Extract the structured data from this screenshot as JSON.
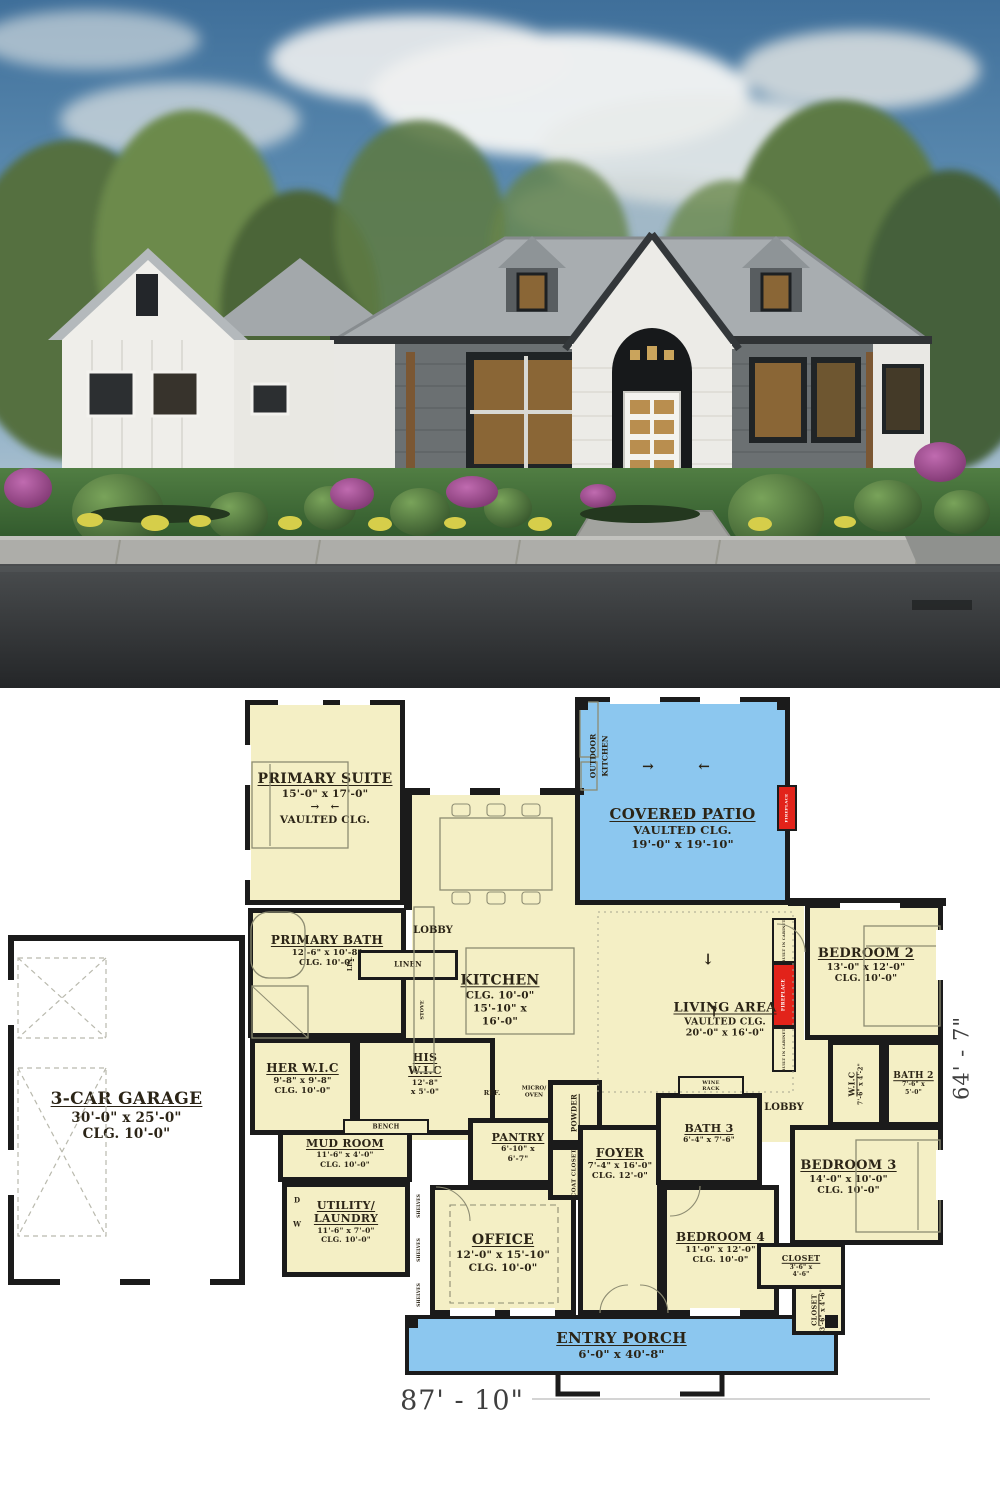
{
  "colors": {
    "room_fill": "#f4efc5",
    "patio_fill": "#8cc7ef",
    "wall": "#1b1b1b",
    "fireplace_red": "#e2231a",
    "label_ink": "#2b2416",
    "furniture_line": "#8d8c72"
  },
  "photo": {
    "description_colors": {
      "sky": "#4f7ea3",
      "roof": "#a8adb0",
      "siding_dark": "#6b7072",
      "siding_white": "#eceae5",
      "grass": "#3f6d38",
      "road": "#3a3d3f",
      "shrub_purple": "#a2408f"
    }
  },
  "dimensions": {
    "overall_width": "87' - 10\"",
    "overall_height": "64' - 7\""
  },
  "plan": {
    "fills": {
      "cream": "#f4efc5",
      "blue": "#8cc7ef",
      "white": "#ffffff",
      "red": "#e2231a"
    },
    "rooms": [
      {
        "id": "great-room-floor",
        "x": 412,
        "y": 900,
        "w": 392,
        "h": 240,
        "fill": "cream",
        "bw": 0
      },
      {
        "id": "dining-floor",
        "x": 408,
        "y": 790,
        "w": 172,
        "h": 115,
        "fill": "cream",
        "bw": 0
      },
      {
        "id": "linen-hall-floor",
        "x": 350,
        "y": 976,
        "w": 64,
        "h": 64,
        "fill": "cream",
        "bw": 0
      },
      {
        "id": "bedroom-hall-floor",
        "x": 756,
        "y": 1040,
        "w": 104,
        "h": 102,
        "fill": "cream",
        "bw": 0
      },
      {
        "id": "covered-patio",
        "title": "COVERED PATIO",
        "lines": [
          "VAULTED CLG.",
          "19'-0\" x 19'-10\""
        ],
        "x": 575,
        "y": 697,
        "w": 215,
        "h": 208,
        "fill": "blue",
        "ts": 15,
        "ly": 103
      },
      {
        "id": "entry-porch",
        "title": "ENTRY PORCH",
        "lines": [
          "6'-0\" x 40'-8\""
        ],
        "x": 405,
        "y": 1315,
        "w": 433,
        "h": 60,
        "fill": "blue",
        "ts": 15,
        "ly": 10,
        "bw": 4
      },
      {
        "id": "garage",
        "title": "3-CAR GARAGE",
        "lines": [
          "30'-0\" x 25'-0\"",
          "CLG. 10'-0\""
        ],
        "x": 8,
        "y": 935,
        "w": 237,
        "h": 350,
        "fill": "white",
        "ts": 17,
        "ly": 148,
        "bw": 6
      },
      {
        "id": "primary-suite",
        "title": "PRIMARY SUITE",
        "lines": [
          "15'-0\" x 17'-0\"",
          "→  ←",
          "VAULTED CLG."
        ],
        "x": 245,
        "y": 700,
        "w": 160,
        "h": 205,
        "ts": 14,
        "ly": 66
      },
      {
        "id": "primary-bath",
        "title": "PRIMARY BATH",
        "lines": [
          "12'-6\" x 10'-8\"",
          "CLG. 10'-0\""
        ],
        "x": 248,
        "y": 908,
        "w": 158,
        "h": 130,
        "ts": 12,
        "ly": 20
      },
      {
        "id": "linen",
        "title": "LINEN",
        "x": 358,
        "y": 950,
        "w": 100,
        "h": 30,
        "ts": 7,
        "u": false,
        "bw": 3
      },
      {
        "id": "her-wic",
        "title": "HER W.I.C",
        "lines": [
          "9'-8\" x 9'-8\"",
          "CLG. 10'-0\""
        ],
        "x": 250,
        "y": 1038,
        "w": 105,
        "h": 97,
        "ts": 12,
        "ly": 18
      },
      {
        "id": "his-wic",
        "title_lines": [
          "HIS",
          "W.I.C"
        ],
        "lines": [
          "12'-8\"",
          "x 5'-0\""
        ],
        "x": 355,
        "y": 1038,
        "w": 140,
        "h": 97,
        "ts": 11,
        "ly": 8
      },
      {
        "id": "mud-room",
        "title": "MUD ROOM",
        "lines": [
          "11'-6\" x 4'-0\"",
          "CLG. 10'-0\""
        ],
        "x": 278,
        "y": 1130,
        "w": 134,
        "h": 52,
        "ts": 11,
        "ly": 2
      },
      {
        "id": "bench",
        "title": "BENCH",
        "x": 343,
        "y": 1119,
        "w": 86,
        "h": 16,
        "ts": 6,
        "u": false,
        "bw": 2
      },
      {
        "id": "utility-laundry",
        "title_lines": [
          "UTILITY/",
          "LAUNDRY"
        ],
        "lines": [
          "11'-6\" x 7'-0\"",
          "CLG. 10'-0\""
        ],
        "x": 282,
        "y": 1182,
        "w": 128,
        "h": 95,
        "ts": 11,
        "ly": 12
      },
      {
        "id": "office",
        "title": "OFFICE",
        "lines": [
          "12'-0\" x 15'-10\"",
          "CLG. 10'-0\""
        ],
        "x": 430,
        "y": 1185,
        "w": 146,
        "h": 130,
        "ts": 14,
        "ly": 42
      },
      {
        "id": "pantry",
        "title": "PANTRY",
        "lines": [
          "6'-10\" x",
          "6'-7\""
        ],
        "x": 468,
        "y": 1118,
        "w": 100,
        "h": 67,
        "ts": 11,
        "ly": 8
      },
      {
        "id": "powder",
        "title": "POWDER",
        "x": 548,
        "y": 1080,
        "w": 54,
        "h": 65,
        "ts": 7,
        "rot": -90
      },
      {
        "id": "coat-closet",
        "title": "COAT CLOSET",
        "x": 548,
        "y": 1145,
        "w": 54,
        "h": 55,
        "ts": 5.5,
        "rot": -90
      },
      {
        "id": "foyer",
        "title": "FOYER",
        "lines": [
          "7'-4\" x 16'-0\"",
          "CLG. 12'-0\""
        ],
        "x": 578,
        "y": 1125,
        "w": 84,
        "h": 190,
        "ts": 12,
        "ly": 16
      },
      {
        "id": "bath-3",
        "title": "BATH 3",
        "lines": [
          "6'-4\" x 7'-6\""
        ],
        "x": 656,
        "y": 1093,
        "w": 106,
        "h": 92,
        "ts": 11,
        "ly": 24
      },
      {
        "id": "wine-rack",
        "title_lines": [
          "WINE",
          "RACK"
        ],
        "x": 678,
        "y": 1076,
        "w": 66,
        "h": 20,
        "ts": 5,
        "u": false,
        "bw": 2
      },
      {
        "id": "bedroom-2",
        "title": "BEDROOM 2",
        "lines": [
          "13'-0\" x 12'-0\"",
          "CLG. 10'-0\""
        ],
        "x": 805,
        "y": 903,
        "w": 138,
        "h": 137,
        "ts": 13,
        "ly": 38,
        "lx": -8
      },
      {
        "id": "wic-2",
        "title": "W.I.C",
        "lines": [
          "7'-6\" x 4'-2\""
        ],
        "x": 828,
        "y": 1040,
        "w": 56,
        "h": 87,
        "ts": 8,
        "rot": -90
      },
      {
        "id": "bath-2",
        "title": "BATH 2",
        "lines": [
          "7'-6\" x",
          "5'-0\""
        ],
        "x": 884,
        "y": 1040,
        "w": 59,
        "h": 87,
        "ts": 9
      },
      {
        "id": "bedroom-3",
        "title": "BEDROOM 3",
        "lines": [
          "14'-0\" x 10'-0\"",
          "CLG. 10'-0\""
        ],
        "x": 790,
        "y": 1125,
        "w": 153,
        "h": 120,
        "ts": 13,
        "ly": 28,
        "lx": -18
      },
      {
        "id": "bedroom-4",
        "title": "BEDROOM 4",
        "lines": [
          "11'-0\" x 12'-0\"",
          "CLG. 10'-0\""
        ],
        "x": 662,
        "y": 1185,
        "w": 117,
        "h": 130,
        "ts": 12,
        "ly": 40
      },
      {
        "id": "closet-bedroom4",
        "title": "CLOSET",
        "lines": [
          "3'-6\" x",
          "4'-6\""
        ],
        "x": 757,
        "y": 1243,
        "w": 88,
        "h": 46,
        "ts": 8,
        "bw": 4
      },
      {
        "id": "closet-bedroom3",
        "title": "CLOSET",
        "lines": [
          "3'-6\" x 4'-6\""
        ],
        "x": 792,
        "y": 1285,
        "w": 53,
        "h": 50,
        "ts": 6.5,
        "rot": -90,
        "bw": 4
      },
      {
        "id": "built-in-cabinet-top",
        "title": "BUILT IN CABINET",
        "x": 772,
        "y": 918,
        "w": 24,
        "h": 45,
        "ts": 3.5,
        "rot": -90,
        "u": false,
        "bw": 2
      },
      {
        "id": "fireplace-living",
        "title": "FIREPLACE",
        "x": 772,
        "y": 963,
        "w": 24,
        "h": 64,
        "ts": 4.5,
        "rot": -90,
        "fill": "red",
        "color": "#ffffff",
        "u": false,
        "bw": 2
      },
      {
        "id": "built-in-cabinet-bottom",
        "title": "BUILT IN CABINET",
        "x": 772,
        "y": 1027,
        "w": 24,
        "h": 45,
        "ts": 3.5,
        "rot": -90,
        "u": false,
        "bw": 2
      },
      {
        "id": "fireplace-patio",
        "title": "FIREPLACE",
        "x": 777,
        "y": 785,
        "w": 20,
        "h": 46,
        "ts": 4,
        "rot": -90,
        "fill": "red",
        "color": "#ffffff",
        "u": false,
        "bw": 2
      },
      {
        "id": "kitchen",
        "title": "KITCHEN",
        "lines": [
          "CLG. 10'-0\"",
          "15'-10\" x",
          "16'-0\""
        ],
        "x": 430,
        "y": 955,
        "w": 140,
        "h": 90,
        "nobox": true,
        "ts": 14
      },
      {
        "id": "living-area",
        "title": "LIVING AREA",
        "lines": [
          "VAULTED CLG.",
          "20'-0\" x 16'-0\""
        ],
        "x": 610,
        "y": 985,
        "w": 230,
        "h": 70,
        "nobox": true,
        "ts": 13
      }
    ],
    "walls": [
      [
        404,
        788,
        180,
        7
      ],
      [
        404,
        788,
        8,
        122
      ],
      [
        788,
        898,
        158,
        8
      ]
    ],
    "annotations": [
      {
        "t": "LOBBY",
        "x": 433,
        "y": 931,
        "s": 10
      },
      {
        "t": "LOBBY",
        "x": 784,
        "y": 1108,
        "s": 10
      },
      {
        "t": "LIN.",
        "x": 351,
        "y": 964,
        "s": 6,
        "r": -90
      },
      {
        "t": "REF.",
        "x": 492,
        "y": 1093,
        "s": 6.5
      },
      {
        "t": "MICRO/",
        "x": 534,
        "y": 1089,
        "s": 5.5
      },
      {
        "t": "OVEN",
        "x": 534,
        "y": 1096,
        "s": 5.5
      },
      {
        "t": "STOVE",
        "x": 423,
        "y": 1010,
        "s": 5,
        "r": -90
      },
      {
        "t": "W",
        "x": 297,
        "y": 1224,
        "s": 7
      },
      {
        "t": "D",
        "x": 297,
        "y": 1200,
        "s": 7
      },
      {
        "t": "SHELVES",
        "x": 420,
        "y": 1206,
        "s": 4.5,
        "r": -90
      },
      {
        "t": "SHELVES",
        "x": 420,
        "y": 1250,
        "s": 4.5,
        "r": -90
      },
      {
        "t": "SHELVES",
        "x": 420,
        "y": 1295,
        "s": 4.5,
        "r": -90
      },
      {
        "t": "OUTDOOR",
        "x": 593,
        "y": 756,
        "s": 7.5,
        "r": -90
      },
      {
        "t": "KITCHEN",
        "x": 605,
        "y": 756,
        "s": 7.5,
        "r": -90
      },
      {
        "t": "→",
        "x": 648,
        "y": 767,
        "s": 14
      },
      {
        "t": "←",
        "x": 704,
        "y": 767,
        "s": 14
      },
      {
        "t": "↓",
        "x": 708,
        "y": 960,
        "s": 15
      },
      {
        "t": "↑",
        "x": 714,
        "y": 1012,
        "s": 15
      },
      {
        "t": "87' - 10\"",
        "x": 462,
        "y": 1401,
        "s": 27,
        "f": "dim"
      },
      {
        "t": "64' - 7\"",
        "x": 962,
        "y": 1058,
        "s": 21,
        "r": -90,
        "f": "dim"
      }
    ],
    "furniture": {
      "dashed_x_boxes": [
        [
          18,
          958,
          88,
          80
        ],
        [
          18,
          1068,
          88,
          168
        ]
      ],
      "outline_rects": [
        [
          252,
          762,
          96,
          86
        ],
        [
          440,
          818,
          112,
          72
        ],
        [
          466,
          948,
          108,
          86
        ],
        [
          414,
          907,
          20,
          165
        ],
        [
          864,
          926,
          76,
          100
        ],
        [
          856,
          1140,
          84,
          92
        ],
        [
          580,
          702,
          18,
          55
        ],
        [
          581,
          762,
          16,
          28
        ]
      ],
      "round_rects": [
        [
          251,
          912,
          54,
          66
        ]
      ],
      "shower": [
        252,
        986,
        56,
        52
      ],
      "chair_stubs": [
        [
          452,
          804,
          18,
          12
        ],
        [
          487,
          804,
          18,
          12
        ],
        [
          522,
          804,
          18,
          12
        ],
        [
          452,
          892,
          18,
          12
        ],
        [
          487,
          892,
          18,
          12
        ],
        [
          522,
          892,
          18,
          12
        ]
      ],
      "dashed_rects": [
        [
          450,
          1205,
          108,
          98
        ]
      ],
      "dotted_rects": [
        [
          598,
          912,
          195,
          180
        ]
      ],
      "lines": [
        [
          270,
          764,
          270,
          846
        ],
        [
          866,
          946,
          938,
          946
        ],
        [
          918,
          1142,
          918,
          1230
        ]
      ],
      "arc_paths": [
        "M436,1187 a34,34 0 0 1 34,34",
        "M805,952 a28,28 0 0 0 -28,-28",
        "M700,1186 a30,30 0 0 1 -30,30",
        "M600,1313 a28,28 0 0 1 28,-28",
        "M668,1313 a28,28 0 0 0 -28,-28"
      ],
      "black_squares": [
        [
          405,
          1315,
          13
        ],
        [
          825,
          1315,
          13
        ],
        [
          575,
          697,
          13
        ],
        [
          777,
          697,
          13
        ]
      ],
      "steps": [
        [
          558,
          1375,
          558,
          1394,
          600,
          1394
        ],
        [
          722,
          1375,
          722,
          1394,
          680,
          1394
        ]
      ],
      "dim_line": [
        532,
        1399,
        930,
        1399
      ],
      "wall_gaps": [
        [
          278,
          697,
          45,
          8
        ],
        [
          340,
          697,
          30,
          8
        ],
        [
          243,
          745,
          8,
          40
        ],
        [
          243,
          850,
          8,
          30
        ],
        [
          8,
          980,
          8,
          45
        ],
        [
          8,
          1150,
          8,
          45
        ],
        [
          60,
          1277,
          60,
          8
        ],
        [
          150,
          1277,
          60,
          8
        ],
        [
          936,
          930,
          8,
          50
        ],
        [
          936,
          1150,
          8,
          50
        ],
        [
          840,
          903,
          60,
          7
        ],
        [
          610,
          697,
          50,
          7
        ],
        [
          700,
          697,
          40,
          7
        ],
        [
          430,
          788,
          40,
          7
        ],
        [
          500,
          788,
          40,
          7
        ],
        [
          450,
          1308,
          45,
          8
        ],
        [
          510,
          1308,
          45,
          8
        ],
        [
          690,
          1308,
          50,
          8
        ]
      ]
    }
  }
}
